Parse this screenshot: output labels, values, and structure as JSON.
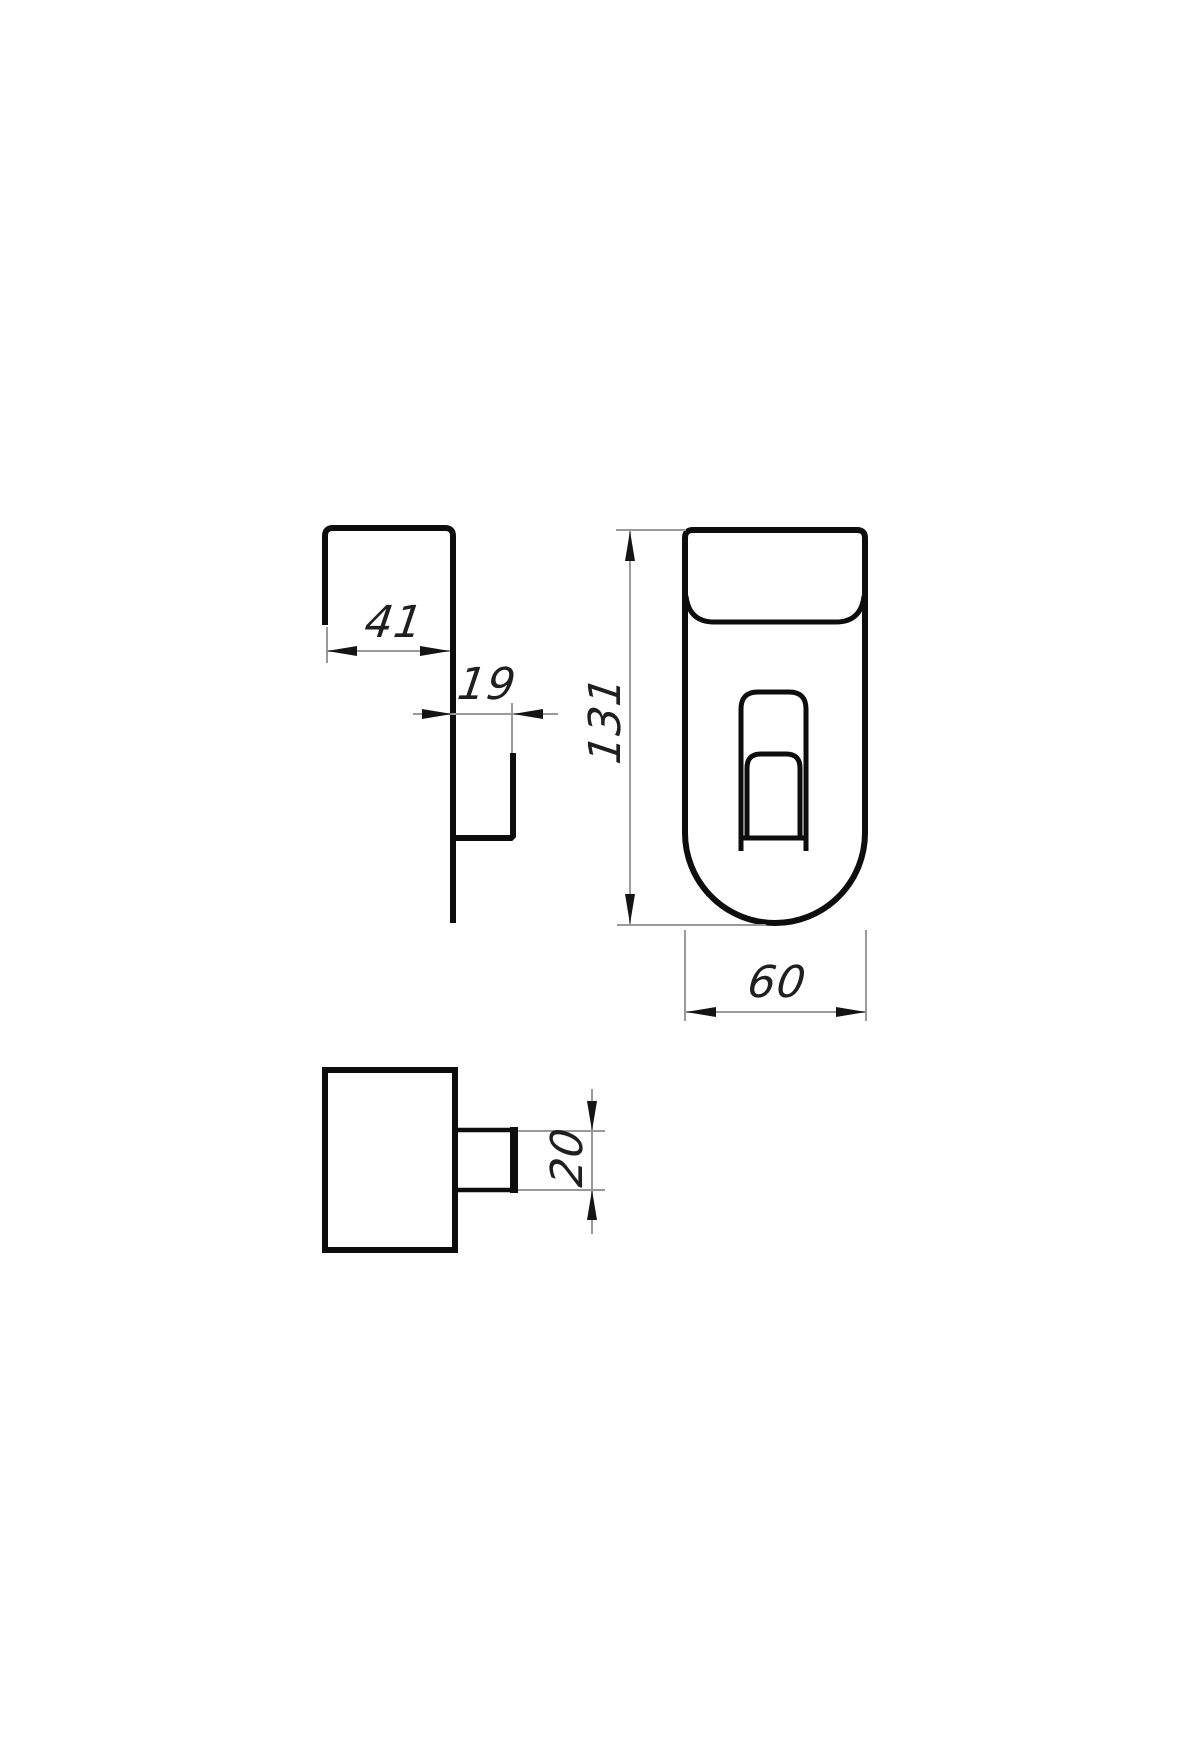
{
  "drawing": {
    "type": "technical-orthographic-views",
    "part": "sheet-metal door hook",
    "views": [
      {
        "id": "side-view",
        "dimensions": [
          "41",
          "19"
        ]
      },
      {
        "id": "front-view",
        "dimensions": [
          "131",
          "60"
        ]
      },
      {
        "id": "top-view",
        "dimensions": [
          "20"
        ]
      }
    ]
  },
  "dims": {
    "flange_width": "41",
    "hook_offset": "19",
    "height": "131",
    "width": "60",
    "hook_width": "20"
  },
  "colors": {
    "background": "#ffffff",
    "object_line": "#0d0d0d",
    "dim_line": "#9a9a9a",
    "arrow": "#141414",
    "text": "#1f1f1f"
  }
}
